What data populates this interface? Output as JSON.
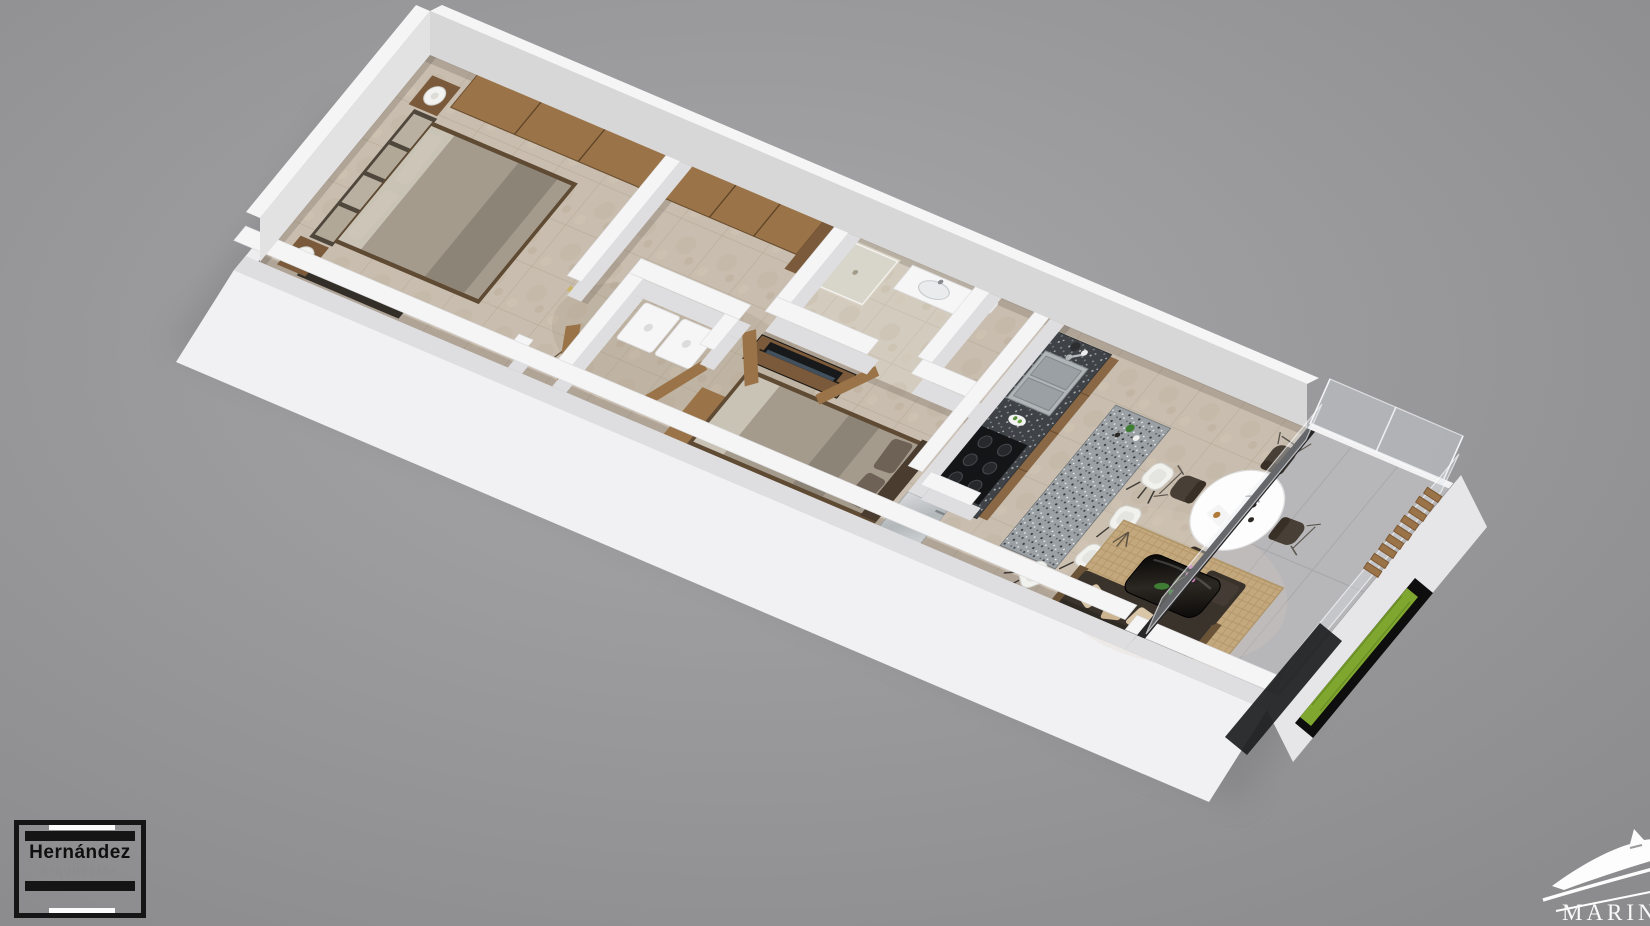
{
  "scene": {
    "description": "3D rendered isometric floor plan of a two-bedroom apartment with balcony, viewed from above on a plain gray studio backdrop"
  },
  "branding": {
    "architect": {
      "name": "Hernández",
      "subtitle": "arquitectos"
    },
    "developer": {
      "name": "MARINA"
    }
  },
  "palette": {
    "bg1": "#a7a7a9",
    "bg2": "#8d8d8f",
    "wallTop": "#f5f5f6",
    "wallFace": "#dedddf",
    "floorTile": "#c8bdae",
    "grout": "#b4a794",
    "bathFloor": "#d3cbbd",
    "balconyFloor": "#b7b7b9",
    "wood": "#9a7448",
    "woodDark": "#7a5a3a",
    "woodLight": "#8a6845",
    "graniteDark": "#3f4347",
    "graniteLight": "#9aa0a4",
    "steel": "#c6c9cb",
    "sofa": "#3a332c",
    "rug": "#c3a87d",
    "coffeeTable": "#14120f",
    "duvet": "#a49b8d",
    "mattress": "#b3aa9c",
    "cushion": "#d9c5a8",
    "chair": "#483f36",
    "stool": "#f1f1ee",
    "plantGreen": "#7fa62e",
    "leafGreen": "#3e7d33",
    "orchidPink": "#c77fb4",
    "trackDark": "#27272a",
    "logoBlack": "#151515"
  },
  "rooms": [
    {
      "name": "master-bedroom",
      "contents": [
        "double bed",
        "headboard cushions",
        "two nightstands",
        "table lamps",
        "sliding-door closet",
        "low dresser"
      ]
    },
    {
      "name": "hallway",
      "contents": [
        "wardrobe",
        "entry door",
        "coat stand"
      ]
    },
    {
      "name": "utility-room",
      "contents": [
        "washer",
        "dryer"
      ]
    },
    {
      "name": "bathroom",
      "contents": [
        "shower",
        "vanity sink",
        "toilet"
      ]
    },
    {
      "name": "second-bedroom",
      "contents": [
        "double bed",
        "tv console",
        "tv",
        "closet"
      ]
    },
    {
      "name": "kitchen",
      "contents": [
        "granite counter",
        "double sink",
        "gas stove",
        "refrigerator",
        "island bar",
        "bar stools"
      ]
    },
    {
      "name": "dining-area",
      "contents": [
        "round white table",
        "four wire-base chairs",
        "tableware"
      ]
    },
    {
      "name": "living-room",
      "contents": [
        "dark sofa",
        "patterned cushions",
        "black coffee table",
        "orchid",
        "jute rug",
        "tripod lamp"
      ]
    },
    {
      "name": "balcony",
      "contents": [
        "glass railing",
        "wood louvers",
        "green planter",
        "sliding glass door"
      ]
    }
  ]
}
